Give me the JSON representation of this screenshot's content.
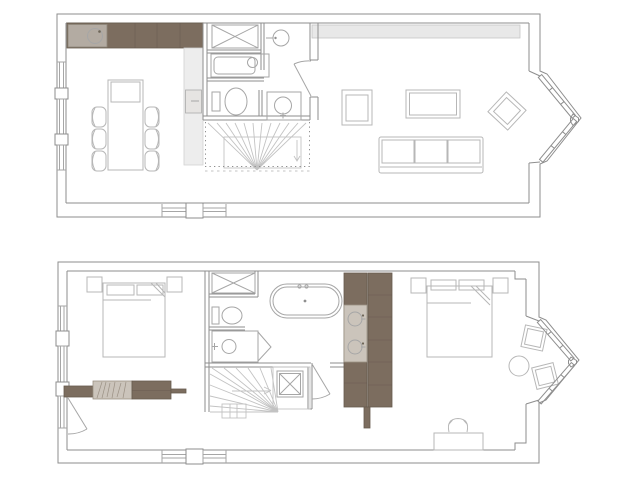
{
  "document": {
    "kind": "architectural-floor-plan",
    "sheets": 2,
    "arrangement": "two plans stacked vertically, upper floor on top, lower floor below",
    "visible_text": []
  },
  "colors": {
    "bg": "#ffffff",
    "wall_line": "#8e8e8e",
    "fixture_line": "#a6a6a6",
    "furniture_line": "#b7b7b7",
    "stair_line": "#c3c3c3",
    "wood_dark": "#7c6d5f",
    "wood_edge": "#665a4e",
    "beige_sink": "#b3aba2",
    "beige_light": "#cbc4bb",
    "hatch_line": "#9b9185",
    "gray_band": "#e8e8e8",
    "gray_band_edge": "#c6c6c6",
    "cabinet_gray": "#ededed",
    "cabinet_edge": "#d2d2d2"
  },
  "plans": [
    {
      "id": "upper-floor-plan",
      "rooms": [
        "kitchen-dining",
        "bathroom",
        "wc-basin-room",
        "hallway",
        "living-room"
      ],
      "fixtures": [
        "kitchen-counter",
        "kitchen-sink",
        "tall-cabinet",
        "oven",
        "dining-table",
        "head-chair",
        "dining-chairs",
        "washing-machine",
        "small-bathtub",
        "washbasin",
        "toilet",
        "shower",
        "winder-stairs",
        "door-swing",
        "storage-band",
        "armchair",
        "coffee-table",
        "accent-chair",
        "sofa",
        "bay-window",
        "left-wall-windows",
        "bottom-wall-windows"
      ],
      "dining_chairs_count": 6,
      "bay_window_panes": 2
    },
    {
      "id": "lower-floor-plan",
      "rooms": [
        "bedroom-1",
        "bathroom",
        "stair-hall",
        "bedroom-2"
      ],
      "fixtures": [
        "double-bed-1",
        "nightstands-1",
        "wardrobe-sideboard",
        "washing-machine",
        "toilet",
        "shower",
        "freestanding-bathtub",
        "double-vanity",
        "winder-stairs",
        "landing-rooflight",
        "landing-door",
        "double-bed-2",
        "nightstands-2",
        "bay-window",
        "round-side-table",
        "lounge-chairs",
        "desk",
        "desk-chair",
        "left-wall-windows",
        "bottom-wall-windows",
        "entry-door"
      ],
      "vanity_basins_count": 2,
      "lounge_chairs_count": 2,
      "bay_window_panes": 2
    }
  ]
}
